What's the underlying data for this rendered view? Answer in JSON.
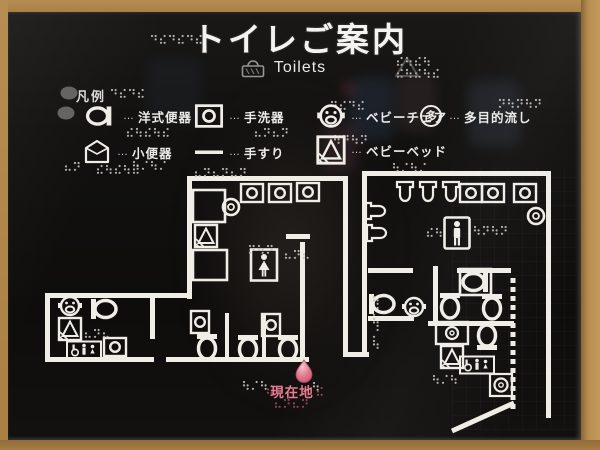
{
  "header": {
    "title_ja": "トイレご案内",
    "title_en": "Toilets"
  },
  "legend": {
    "heading": "凡例",
    "separator": "…",
    "items": [
      {
        "name": "western-toilet",
        "label": "洋式便器"
      },
      {
        "name": "hand-washer",
        "label": "手洗器"
      },
      {
        "name": "baby-chair",
        "label": "ベビーチェア"
      },
      {
        "name": "multipurpose-sink",
        "label": "多目的流し",
        "icon_char": "多"
      },
      {
        "name": "urinal",
        "label": "小便器"
      },
      {
        "name": "handrail",
        "label": "手すり"
      },
      {
        "name": "baby-bed",
        "label": "ベビーベッド"
      }
    ]
  },
  "current_location": {
    "label": "現在地",
    "color": "#e87c90",
    "marker": {
      "x": 304,
      "y": 371
    }
  },
  "colors": {
    "wall": "#f0ede7",
    "sign_bg": "#121110",
    "frame": "#b18549",
    "braille": "#c4c2be",
    "braille_red": "#9a4a58",
    "tactile_dot": "#6a6a6a"
  },
  "plan": {
    "walls": [
      [
        187,
        176,
        161,
        5
      ],
      [
        362,
        171,
        189,
        5
      ],
      [
        187,
        176,
        5,
        123
      ],
      [
        45,
        293,
        147,
        5
      ],
      [
        45,
        293,
        5,
        69
      ],
      [
        45,
        357,
        109,
        5
      ],
      [
        166,
        357,
        143,
        5
      ],
      [
        300,
        242,
        5,
        120
      ],
      [
        286,
        234,
        24,
        5
      ],
      [
        343,
        176,
        5,
        181
      ],
      [
        362,
        176,
        5,
        181
      ],
      [
        343,
        352,
        26,
        5
      ],
      [
        546,
        171,
        5,
        247
      ],
      [
        150,
        293,
        5,
        46
      ],
      [
        225,
        313,
        4,
        49
      ],
      [
        262,
        313,
        4,
        49
      ],
      [
        368,
        268,
        45,
        5
      ],
      [
        433,
        266,
        5,
        57
      ],
      [
        457,
        268,
        54,
        5
      ],
      [
        368,
        316,
        46,
        5
      ],
      [
        428,
        321,
        86,
        5
      ]
    ],
    "lines": [
      [
        513,
        278,
        513,
        410,
        1
      ],
      [
        452,
        431,
        514,
        403,
        0
      ]
    ],
    "boxes": [
      [
        193,
        190,
        32,
        32
      ],
      [
        193,
        250,
        34,
        30
      ],
      [
        460,
        269,
        31,
        26
      ]
    ],
    "fixtures": [
      [
        "basin",
        252,
        193,
        0
      ],
      [
        "basin",
        280,
        193,
        0
      ],
      [
        "basin",
        308,
        192,
        0
      ],
      [
        "round-basin",
        231,
        207,
        0
      ],
      [
        "baby-bed",
        206,
        236,
        0
      ],
      [
        "woman-box",
        264,
        265,
        0
      ],
      [
        "basin",
        200,
        322,
        90
      ],
      [
        "basin",
        271,
        325,
        90
      ],
      [
        "toilet",
        207,
        347,
        0
      ],
      [
        "toilet",
        248,
        348,
        0
      ],
      [
        "toilet",
        288,
        348,
        0
      ],
      [
        "baby-chair",
        70,
        306,
        0
      ],
      [
        "baby-bed",
        70,
        329,
        0
      ],
      [
        "toilet",
        104,
        309,
        270
      ],
      [
        "basin",
        115,
        347,
        0
      ],
      [
        "accessible-sign",
        84,
        350,
        0
      ],
      [
        "urinal",
        405,
        192,
        0
      ],
      [
        "urinal",
        428,
        192,
        0
      ],
      [
        "urinal",
        451,
        192,
        0
      ],
      [
        "basin",
        471,
        193,
        0
      ],
      [
        "basin",
        493,
        193,
        0
      ],
      [
        "basin",
        525,
        193,
        0
      ],
      [
        "round-basin",
        536,
        216,
        0
      ],
      [
        "urinal",
        376,
        211,
        270
      ],
      [
        "urinal",
        377,
        233,
        270
      ],
      [
        "man-box",
        457,
        233,
        0
      ],
      [
        "toilet",
        382,
        304,
        270
      ],
      [
        "baby-chair",
        414,
        307,
        0
      ],
      [
        "toilet",
        450,
        306,
        0
      ],
      [
        "toilet",
        492,
        307,
        0
      ],
      [
        "toilet",
        475,
        282,
        90
      ],
      [
        "basin-box",
        452,
        333,
        0
      ],
      [
        "baby-bed",
        452,
        357,
        0
      ],
      [
        "accessible-sign",
        477,
        365,
        0
      ],
      [
        "round-basin-box",
        501,
        385,
        0
      ],
      [
        "toilet",
        487,
        337,
        180
      ]
    ],
    "braille": [
      [
        152,
        36,
        6,
        0,
        0
      ],
      [
        398,
        58,
        4,
        0,
        0
      ],
      [
        398,
        70,
        5,
        0,
        0
      ],
      [
        112,
        90,
        4,
        0,
        0
      ],
      [
        128,
        129,
        5,
        0,
        0
      ],
      [
        256,
        129,
        4,
        0,
        0
      ],
      [
        332,
        102,
        4,
        0,
        0
      ],
      [
        500,
        100,
        5,
        0,
        0
      ],
      [
        134,
        162,
        4,
        0,
        0
      ],
      [
        335,
        136,
        4,
        0,
        0
      ],
      [
        66,
        163,
        2,
        0,
        0
      ],
      [
        98,
        166,
        5,
        0,
        0
      ],
      [
        196,
        169,
        6,
        0,
        0
      ],
      [
        394,
        164,
        4,
        0,
        0
      ],
      [
        250,
        246,
        3,
        0,
        0
      ],
      [
        286,
        251,
        3,
        0,
        0
      ],
      [
        428,
        229,
        2,
        0,
        0
      ],
      [
        475,
        227,
        4,
        0,
        0
      ],
      [
        86,
        330,
        3,
        0,
        0
      ],
      [
        374,
        297,
        5,
        1,
        0
      ],
      [
        434,
        376,
        3,
        0,
        0
      ],
      [
        244,
        382,
        3,
        0,
        0
      ],
      [
        314,
        383,
        1,
        0,
        0
      ],
      [
        268,
        386,
        1,
        1,
        1
      ],
      [
        318,
        388,
        1,
        1,
        1
      ],
      [
        276,
        400,
        4,
        0,
        1
      ]
    ],
    "tactile_dots": [
      [
        69,
        93
      ],
      [
        66,
        113
      ]
    ]
  }
}
